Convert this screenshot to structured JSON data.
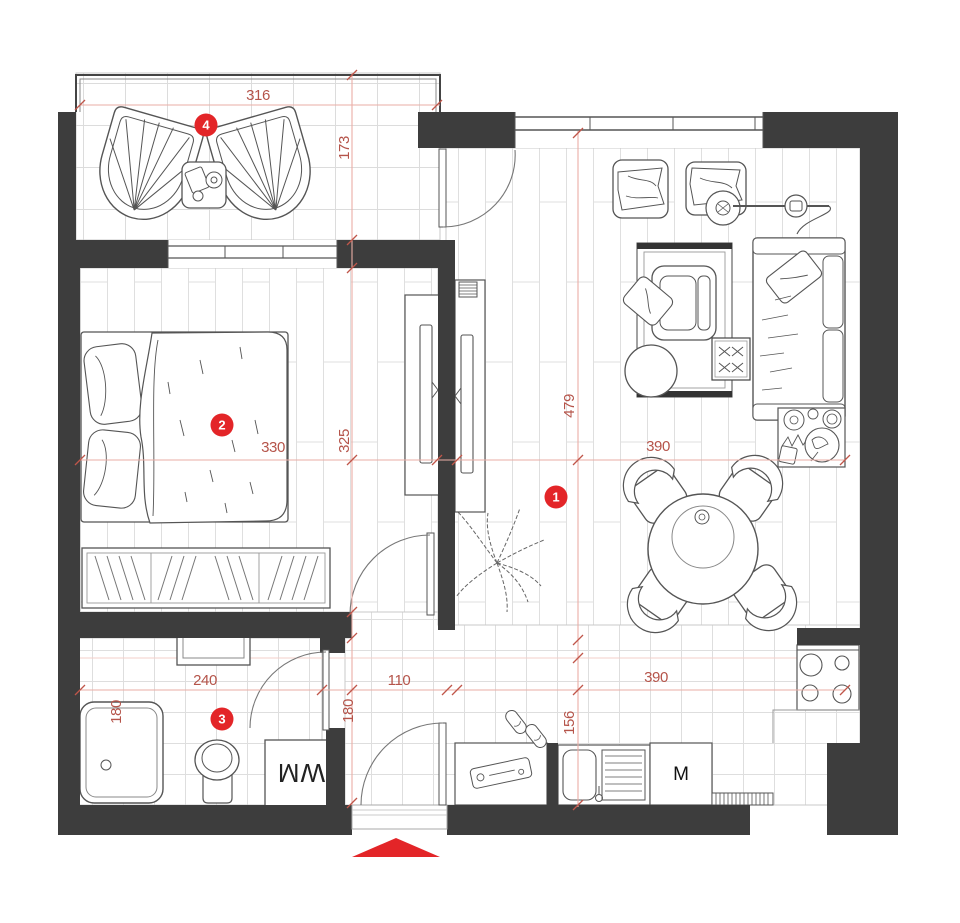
{
  "title": "apartment-floor-plan",
  "rooms": [
    {
      "number": "1",
      "name": "living-room"
    },
    {
      "number": "2",
      "name": "bedroom"
    },
    {
      "number": "3",
      "name": "bathroom"
    },
    {
      "number": "4",
      "name": "balcony"
    }
  ],
  "dimensions": {
    "balcony_width": "316",
    "balcony_depth": "173",
    "living_length": "479",
    "living_width": "390",
    "bedroom_width": "330",
    "bedroom_depth": "325",
    "bathroom_width": "240",
    "bathroom_depth": "180",
    "hallway_width": "110",
    "hallway_depth": "180",
    "kitchen_width": "390",
    "kitchen_counter_depth": "156"
  },
  "appliances": {
    "washing_machine": "WM",
    "oven": "M"
  },
  "colors": {
    "wall": "#3d3d3d",
    "dimension_text": "#b5544a",
    "dimension_line": "#eaaea6",
    "marker": "#e32528",
    "entrance_arrow": "#e32528"
  }
}
